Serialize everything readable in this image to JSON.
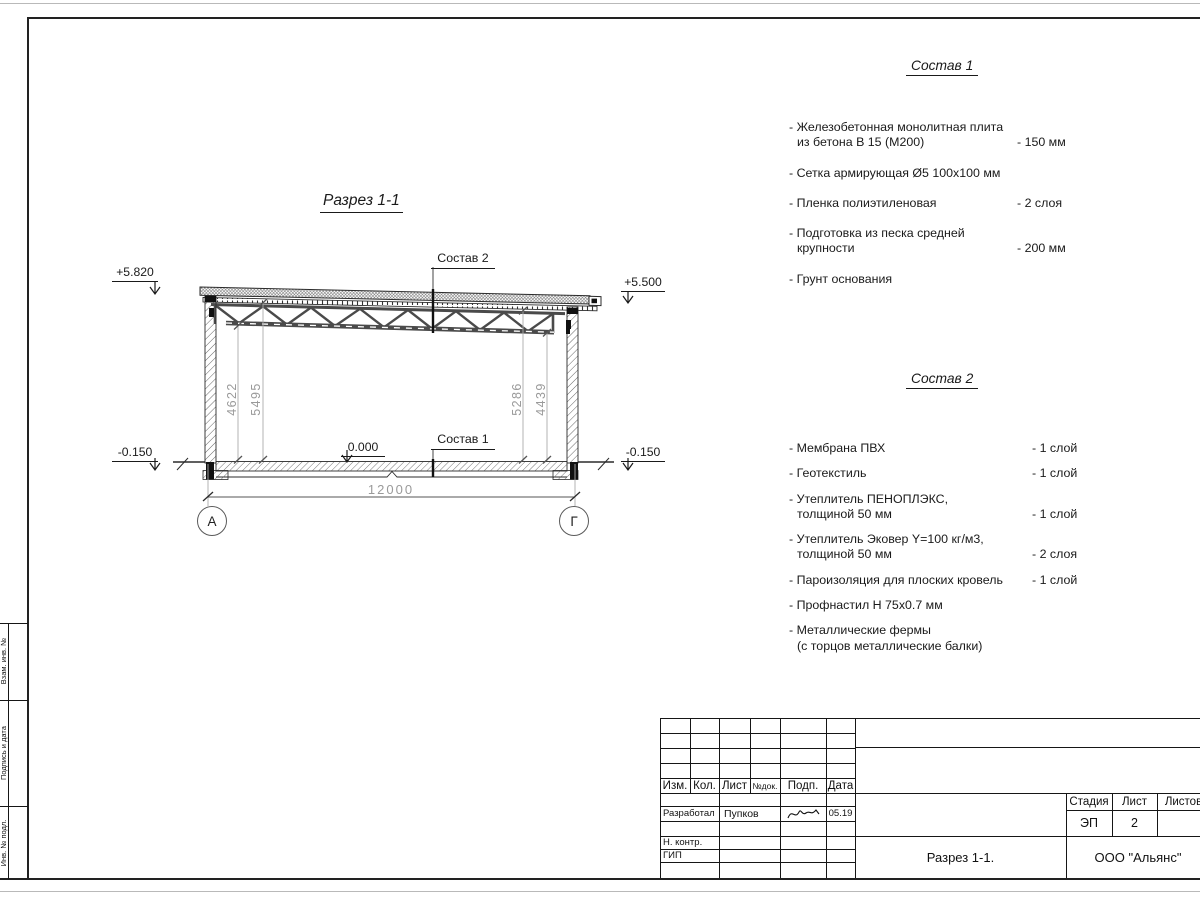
{
  "margin_boxes": {
    "box1": "Взам. инв. №",
    "box2": "Подпись и дата",
    "box3": "Инв. № подл."
  },
  "drawing": {
    "title": "Разрез 1-1",
    "ref_roof": "Состав 2",
    "ref_floor": "Состав 1",
    "elev_top_left": "+5.820",
    "elev_top_right": "+5.500",
    "elev_zero": "0.000",
    "elev_bottom_left": "-0.150",
    "elev_bottom_right": "-0.150",
    "dim_span": "12000",
    "dim_left_inner": "4622",
    "dim_left_outer": "5495",
    "dim_right_inner": "5286",
    "dim_right_outer": "4439",
    "axis_left": "А",
    "axis_right": "Г"
  },
  "sostav1": {
    "title": "Состав 1",
    "items": [
      {
        "l1": "- Железобетонная  монолитная плита",
        "l2": "из бетона В 15 (М200)",
        "value": "- 150 мм"
      },
      {
        "l1": "- Сетка армирующая Ø5 100х100 мм"
      },
      {
        "l1": "- Пленка полиэтиленовая",
        "value": "-  2 слоя"
      },
      {
        "l1": "- Подготовка из песка средней",
        "l2": "крупности",
        "value": "- 200 мм"
      },
      {
        "l1": "- Грунт основания"
      }
    ]
  },
  "sostav2": {
    "title": "Состав 2",
    "items": [
      {
        "l1": "- Мембрана ПВХ",
        "value": "- 1 слой"
      },
      {
        "l1": "- Геотекстиль",
        "value": "- 1 слой"
      },
      {
        "l1": "- Утеплитель ПЕНОПЛЭКС,",
        "l2": "толщиной 50 мм",
        "value": "- 1 слой"
      },
      {
        "l1": "- Утеплитель Эковер Y=100 кг/м3,",
        "l2": "толщиной 50 мм",
        "value": "- 2 слоя"
      },
      {
        "l1": "- Пароизоляция для плоских кровель",
        "value": "- 1 слой"
      },
      {
        "l1": "- Профнастил Н 75х0.7 мм"
      },
      {
        "l1": "- Металлические фермы",
        "l2": "(с торцов металлические балки)"
      }
    ]
  },
  "titleblock": {
    "col_izm": "Изм.",
    "col_kol": "Кол.",
    "col_list": "Лист",
    "col_ndok": "№док.",
    "col_podp": "Подп.",
    "col_data": "Дата",
    "razrabotal_label": "Разработал",
    "razrabotal_name": "Пупков",
    "razrabotal_date": "05.19",
    "nkontr_label": "Н. контр.",
    "gip_label": "ГИП",
    "stage_label": "Стадия",
    "sheet_label": "Лист",
    "sheets_label": "Листов",
    "stage_value": "ЭП",
    "sheet_value": "2",
    "doc_name": "Разрез 1-1.",
    "company": "ООО \"Альянс\""
  }
}
